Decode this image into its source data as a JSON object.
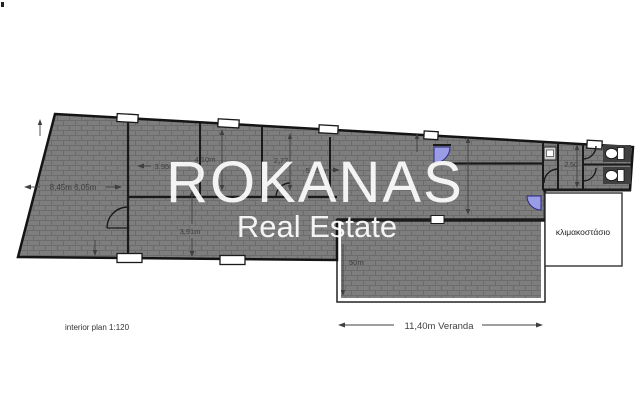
{
  "plan": {
    "watermark": {
      "line1": "ROKANAS",
      "line2": "Real Estate"
    },
    "scale_note": "interior plan 1:120",
    "rooms": {
      "stairwell_label": "κλιμακοστάσιο"
    },
    "dimensions": {
      "room1": "8,45m  6,05m",
      "d395": "3,95m",
      "d410": "4,10m",
      "d277": "2,77",
      "d565": "5,65m",
      "d391": "3,91m",
      "d250": "2,50",
      "d50": "50m",
      "veranda": "11,40m Veranda"
    },
    "colors": {
      "hatch_base": "#7e7e7e",
      "hatch_line": "#6c6c6c",
      "wall": "#1a1a1a",
      "door_blue": "#9a9ce6",
      "dim_text": "#3f3f3f",
      "watermark": "#ffffff"
    }
  }
}
